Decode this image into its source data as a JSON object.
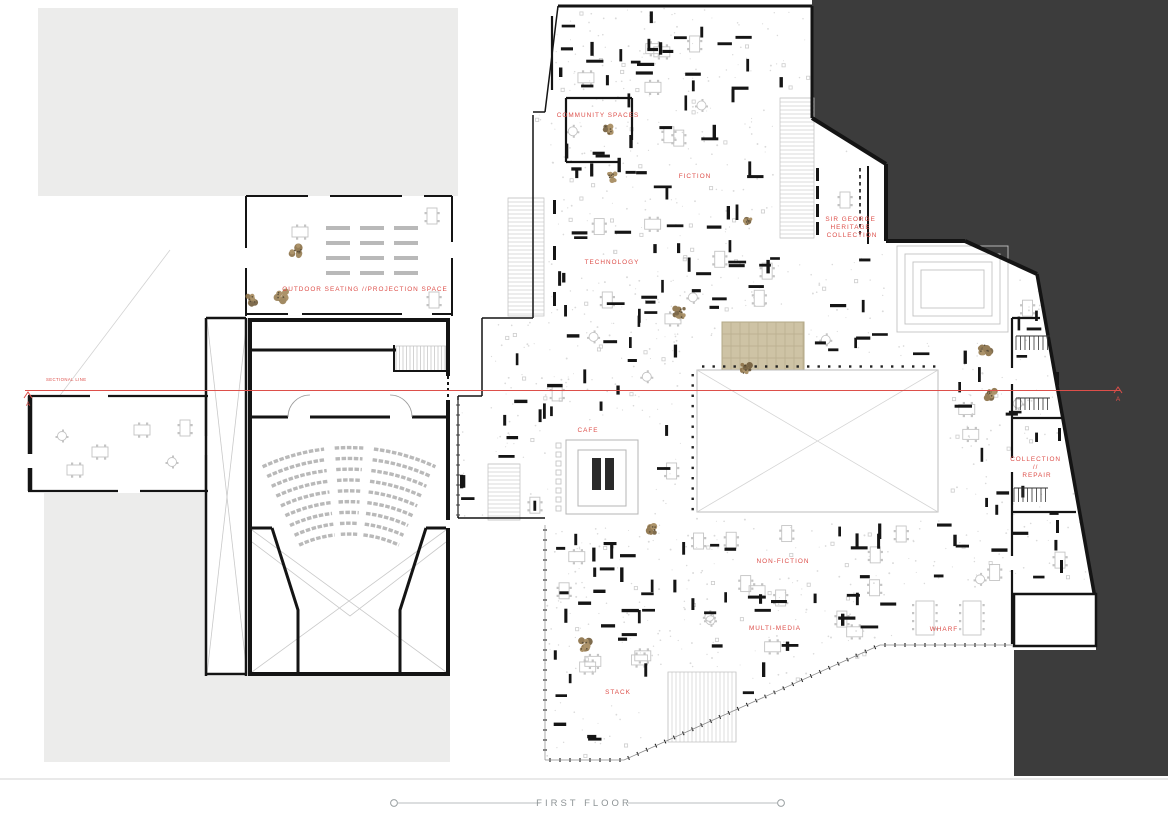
{
  "zones": {
    "community_spaces": "COMMUNITY SPACES",
    "fiction": "FICTION",
    "heritage": [
      "SIR GEORGE",
      "HERITAGE",
      "COLLECTION"
    ],
    "technology": "TECHNOLOGY",
    "outdoor_seating": "OUTDOOR SEATING //PROJECTION SPACE",
    "cafe": "CAFE",
    "collection_repair": [
      "COLLECTION",
      "//",
      "REPAIR"
    ],
    "non_fiction": "NON-FICTION",
    "multi_media": "MULTI-MEDIA",
    "wharf": "WHARF",
    "stack": "STACK"
  },
  "section_line": {
    "label": "SECTIONAL LINE",
    "marker_start": "A",
    "marker_end": "A"
  },
  "footer": {
    "title": "FIRST FLOOR"
  },
  "colors": {
    "accent_red": "#dd4f4a",
    "dark_mass": "#3c3c3c",
    "site_gray": "#ececeb",
    "wall_black": "#141414"
  }
}
